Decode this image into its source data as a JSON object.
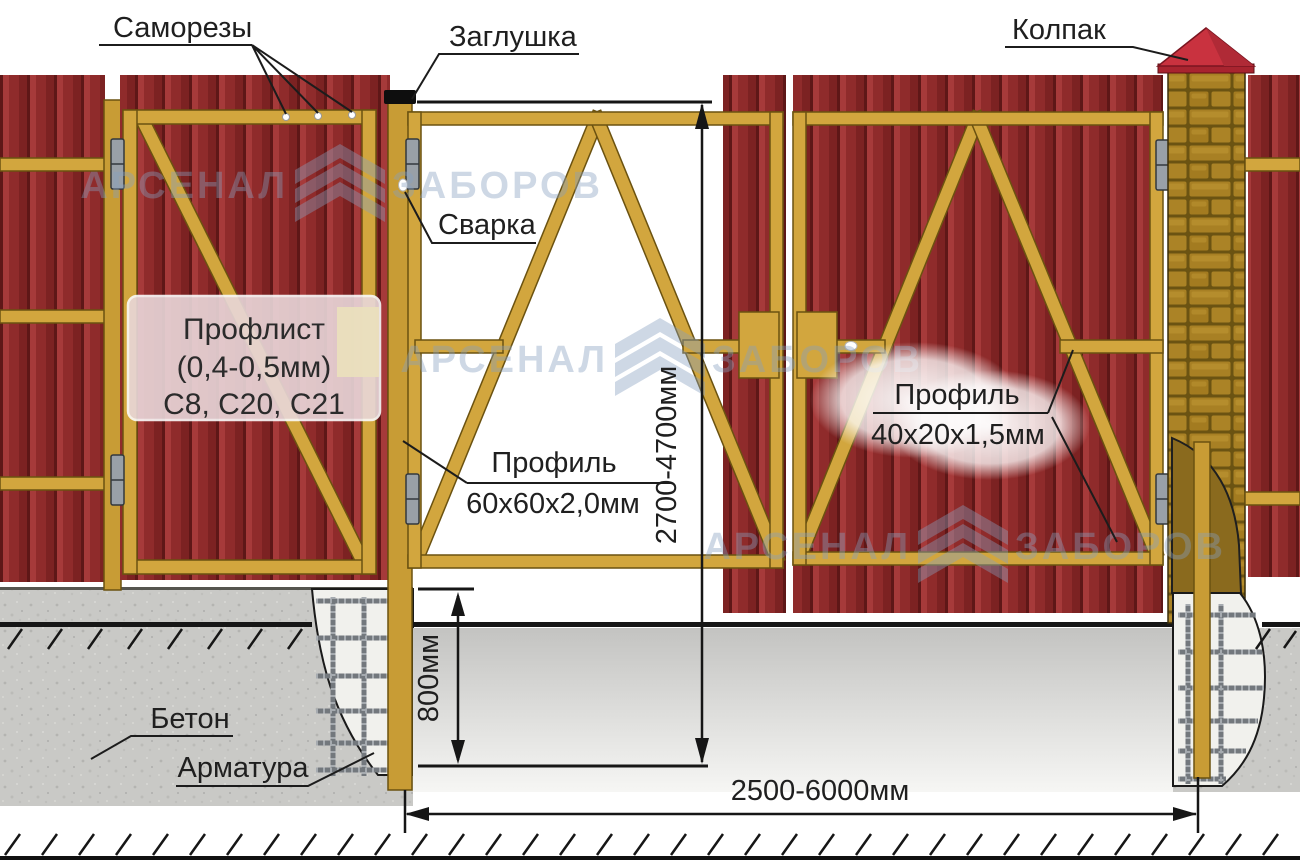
{
  "labels": {
    "samorezy": "Саморезы",
    "zaglushka": "Заглушка",
    "svarka": "Сварка",
    "kolpak": "Колпак",
    "beton": "Бетон",
    "armatura": "Арматура",
    "proflist_line1": "Профлист",
    "proflist_line2": "(0,4-0,5мм)",
    "proflist_line3": "С8, С20, С21",
    "profil60_line1": "Профиль",
    "profil60_line2": "60х60х2,0мм",
    "profil40_line1": "Профиль",
    "profil40_line2": "40х20х1,5мм"
  },
  "dimensions": {
    "height_range": "2700-4700мм",
    "post_depth": "800мм",
    "width_range": "2500-6000мм"
  },
  "watermark": {
    "word1": "АРСЕНАЛ",
    "word2": "ЗАБОРОВ"
  },
  "colors": {
    "sheet_red": "#942e2e",
    "sheet_red_dark": "#5e1717",
    "frame_gold": "#d2a63e",
    "brick": "#a88024",
    "brick_mortar": "#6b5312",
    "cap_red": "#c9323f",
    "concrete": "#c9c9c6",
    "pit_fill": "#f1f1ed",
    "rebar_gray": "#73787d",
    "watermark_blue": "#87a0c0",
    "line_black": "#161616"
  }
}
